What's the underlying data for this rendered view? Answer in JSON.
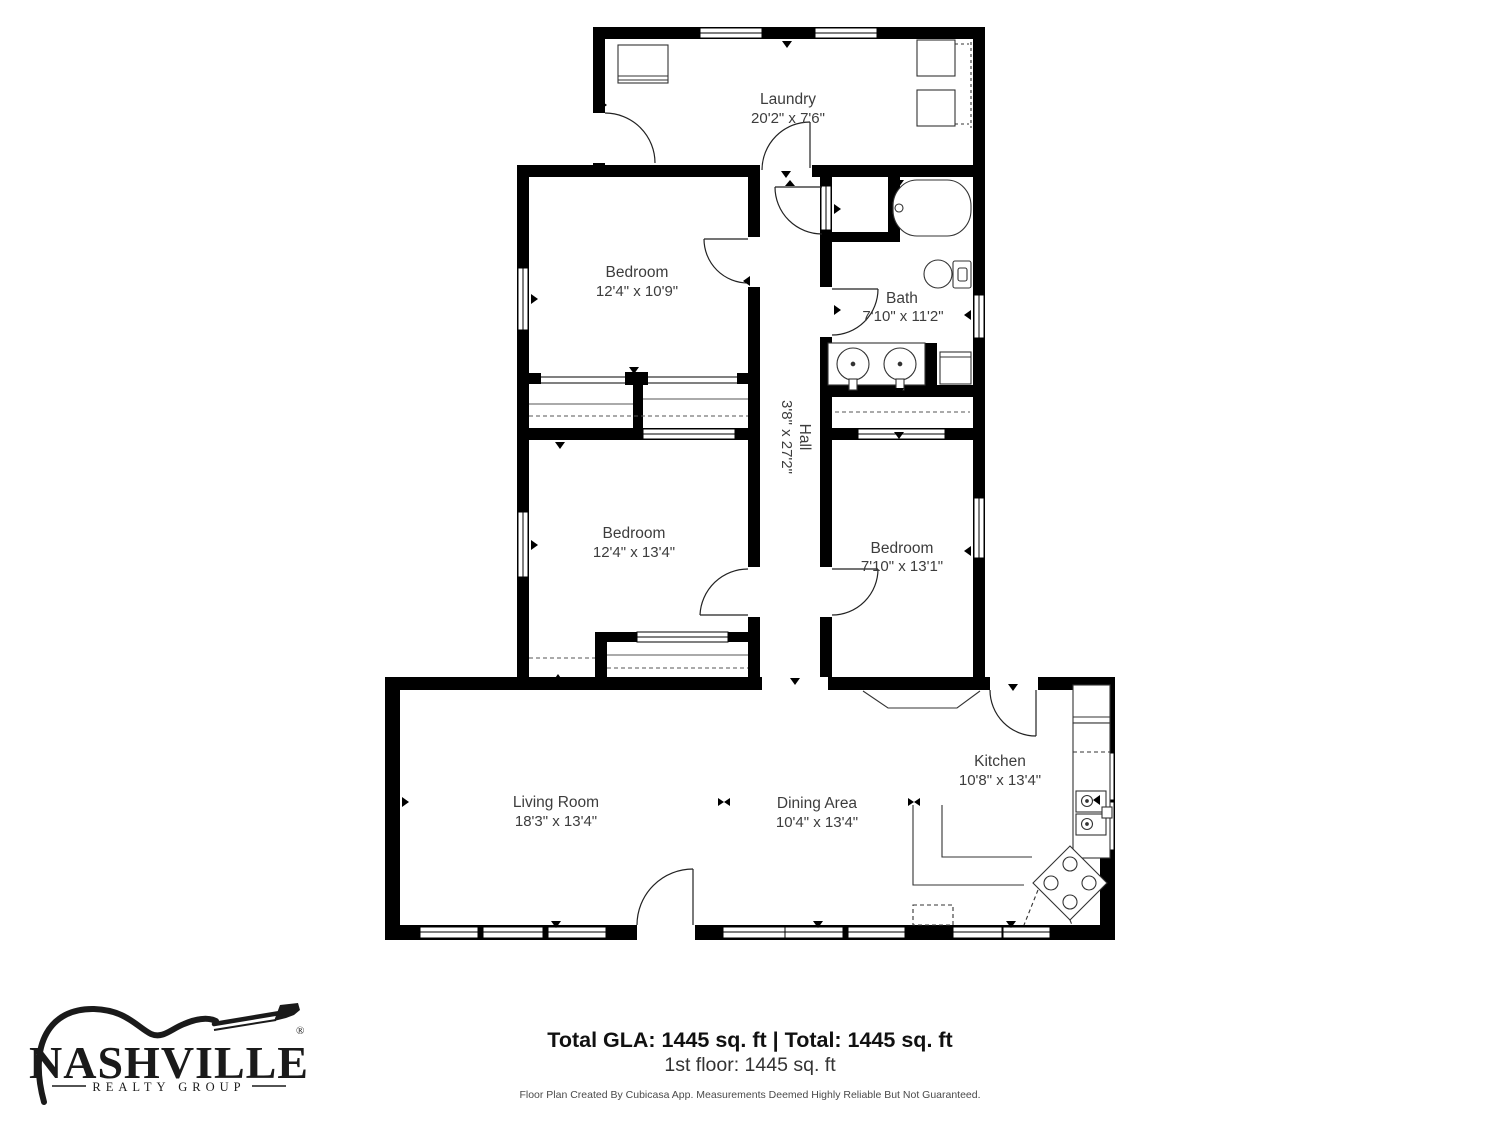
{
  "plan": {
    "rooms": [
      {
        "id": "laundry",
        "name": "Laundry",
        "dims": "20'2\" x 7'6\""
      },
      {
        "id": "bedroom1",
        "name": "Bedroom",
        "dims": "12'4\" x 10'9\""
      },
      {
        "id": "bath",
        "name": "Bath",
        "dims": "7'10\" x 11'2\""
      },
      {
        "id": "hall",
        "name": "Hall",
        "dims": "3'8\" x 27'2\""
      },
      {
        "id": "bedroom2",
        "name": "Bedroom",
        "dims": "12'4\" x 13'4\""
      },
      {
        "id": "bedroom3",
        "name": "Bedroom",
        "dims": "7'10\" x 13'1\""
      },
      {
        "id": "living",
        "name": "Living Room",
        "dims": "18'3\" x 13'4\""
      },
      {
        "id": "dining",
        "name": "Dining Area",
        "dims": "10'4\" x 13'4\""
      },
      {
        "id": "kitchen",
        "name": "Kitchen",
        "dims": "10'8\" x 13'4\""
      }
    ]
  },
  "footer": {
    "totals": "Total GLA: 1445 sq. ft | Total: 1445 sq. ft",
    "floor": "1st floor: 1445 sq. ft",
    "disclaimer": "Floor Plan Created By Cubicasa App. Measurements Deemed Highly Reliable But Not Guaranteed."
  },
  "logo": {
    "name": "NASHVILLE",
    "tagline": "REALTY GROUP",
    "registered": "®"
  },
  "colors": {
    "walls": "#000000",
    "background": "#ffffff",
    "label": "#3d3d3d"
  }
}
